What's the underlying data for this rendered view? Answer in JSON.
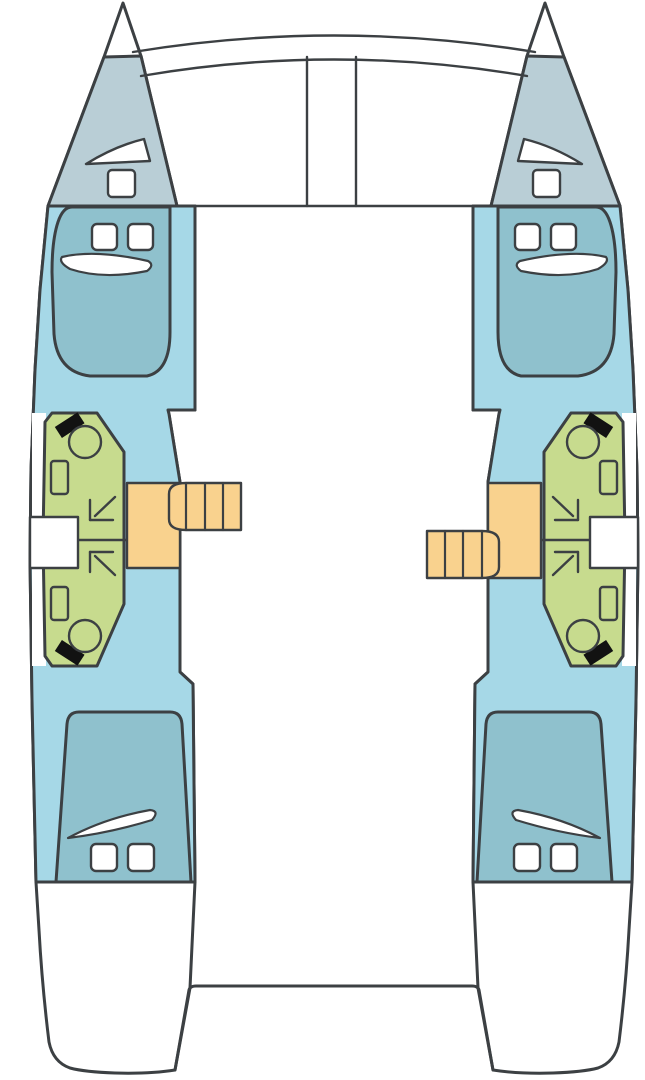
{
  "page": {
    "kind": "catamaran-deck-plan",
    "view": "top-down"
  },
  "colors": {
    "background": "#ffffff",
    "outline": "#3c4043",
    "hull": "#a6d8e7",
    "foredeck": "#b9ced6",
    "bed": "#8fc1cd",
    "bathroom": "#c7db8e",
    "stairs": "#f9d28e",
    "fixture_white": "#ffffff",
    "toilet_tank": "#121212"
  },
  "diagram": {
    "hulls": [
      {
        "side": "port",
        "rooms": [
          "bow-locker",
          "forward-cabin",
          "bathroom-forward",
          "bathroom-aft",
          "aft-cabin"
        ],
        "fixtures": [
          "triangle-deck-hatch",
          "square-deck-hatch",
          "double-berth-forward",
          "cabin-window",
          "cabin-window",
          "hull-window-sliver",
          "toilet",
          "toilet",
          "sink",
          "sink",
          "shower-drain",
          "shower-drain",
          "side-gate-opening",
          "companionway-stairs",
          "stair-landing",
          "double-berth-aft"
        ],
        "stairs": {
          "treads": 4,
          "position": "upper"
        }
      },
      {
        "side": "starboard",
        "rooms": [
          "bow-locker",
          "forward-cabin",
          "bathroom-forward",
          "bathroom-aft",
          "aft-cabin"
        ],
        "fixtures": [
          "triangle-deck-hatch",
          "square-deck-hatch",
          "double-berth-forward",
          "cabin-window",
          "cabin-window",
          "hull-window-sliver",
          "toilet",
          "toilet",
          "sink",
          "sink",
          "shower-drain",
          "shower-drain",
          "side-gate-opening",
          "companionway-stairs",
          "stair-landing",
          "double-berth-aft"
        ],
        "stairs": {
          "treads": 4,
          "position": "lower"
        }
      }
    ],
    "center_structures": [
      "forward-crossbeam",
      "trampoline-area",
      "mast-support-posts",
      "trampoline-aft-edge",
      "transom-platform"
    ]
  }
}
